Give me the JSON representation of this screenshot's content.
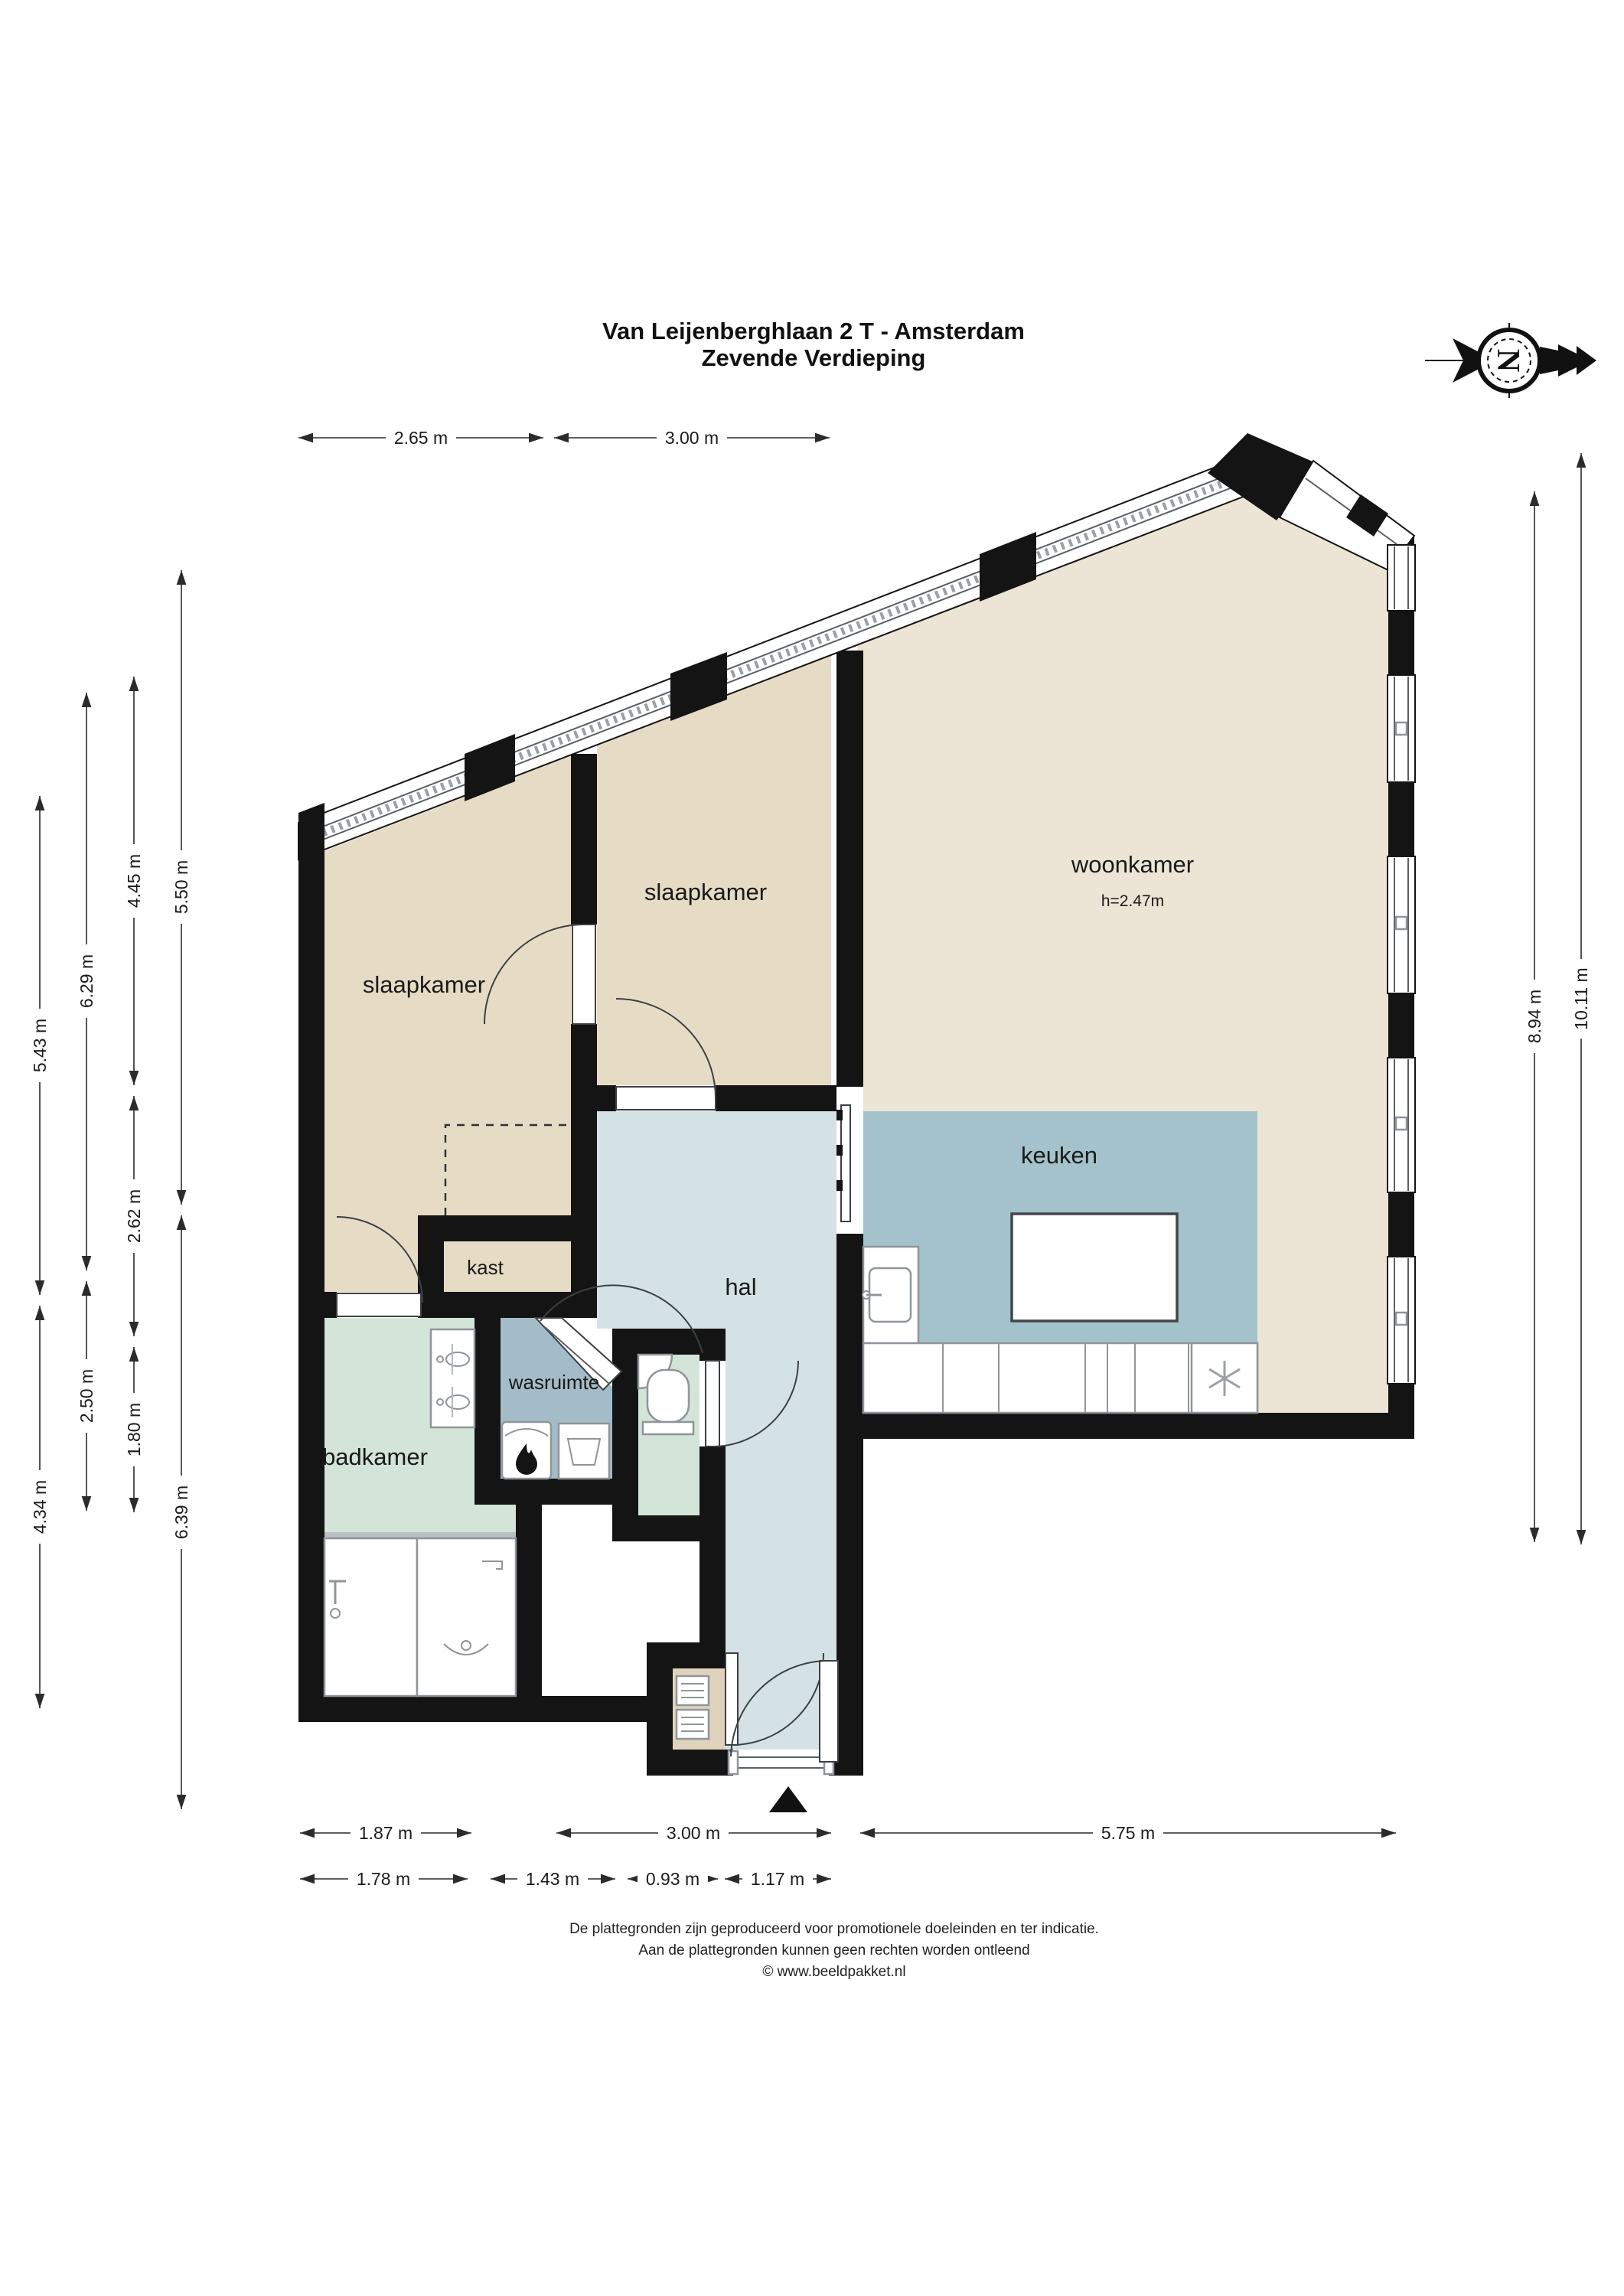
{
  "title": {
    "line1": "Van Leijenberghlaan 2 T - Amsterdam",
    "line2": "Zevende Verdieping"
  },
  "compass": {
    "letter": "N",
    "icon": "north-arrow-pointing-right"
  },
  "entrance_marker": "triangle-up",
  "rooms": {
    "slaapkamer_left": "slaapkamer",
    "slaapkamer_mid": "slaapkamer",
    "woonkamer": "woonkamer",
    "woonkamer_height": "h=2.47m",
    "keuken": "keuken",
    "kast": "kast",
    "hal": "hal",
    "wasruimte": "wasruimte",
    "badkamer": "badkamer"
  },
  "dims": {
    "top_1": "2.65 m",
    "top_2": "3.00 m",
    "left_a1": "5.43 m",
    "left_a2": "4.34 m",
    "left_b1": "6.29 m",
    "left_b2": "2.50 m",
    "left_c1": "4.45 m",
    "left_c2": "2.62 m",
    "left_c3": "1.80 m",
    "left_d1": "5.50 m",
    "left_d2": "6.39 m",
    "right_1": "8.94 m",
    "right_2": "10.11 m",
    "bottom_a1": "1.87 m",
    "bottom_a2": "3.00 m",
    "bottom_a3": "5.75 m",
    "bottom_b1": "1.78 m",
    "bottom_b2": "1.43 m",
    "bottom_b3": "0.93 m",
    "bottom_b4": "1.17 m"
  },
  "footer": {
    "line1": "De plattegronden zijn geproduceerd voor promotionele doeleinden en ter indicatie.",
    "line2": "Aan de plattegronden kunnen geen rechten worden ontleend",
    "line3": "© www.beeldpakket.nl"
  },
  "colors": {
    "wall": "#141414",
    "bedroom": "#e6dcc5",
    "livingroom": "#ece4d5",
    "kitchen": "#a3c2cb",
    "hall": "#d5e2e5",
    "laundry": "#a4bcc8",
    "bathroom": "#d3e4d8",
    "closet_entry": "#e0d3bd"
  }
}
